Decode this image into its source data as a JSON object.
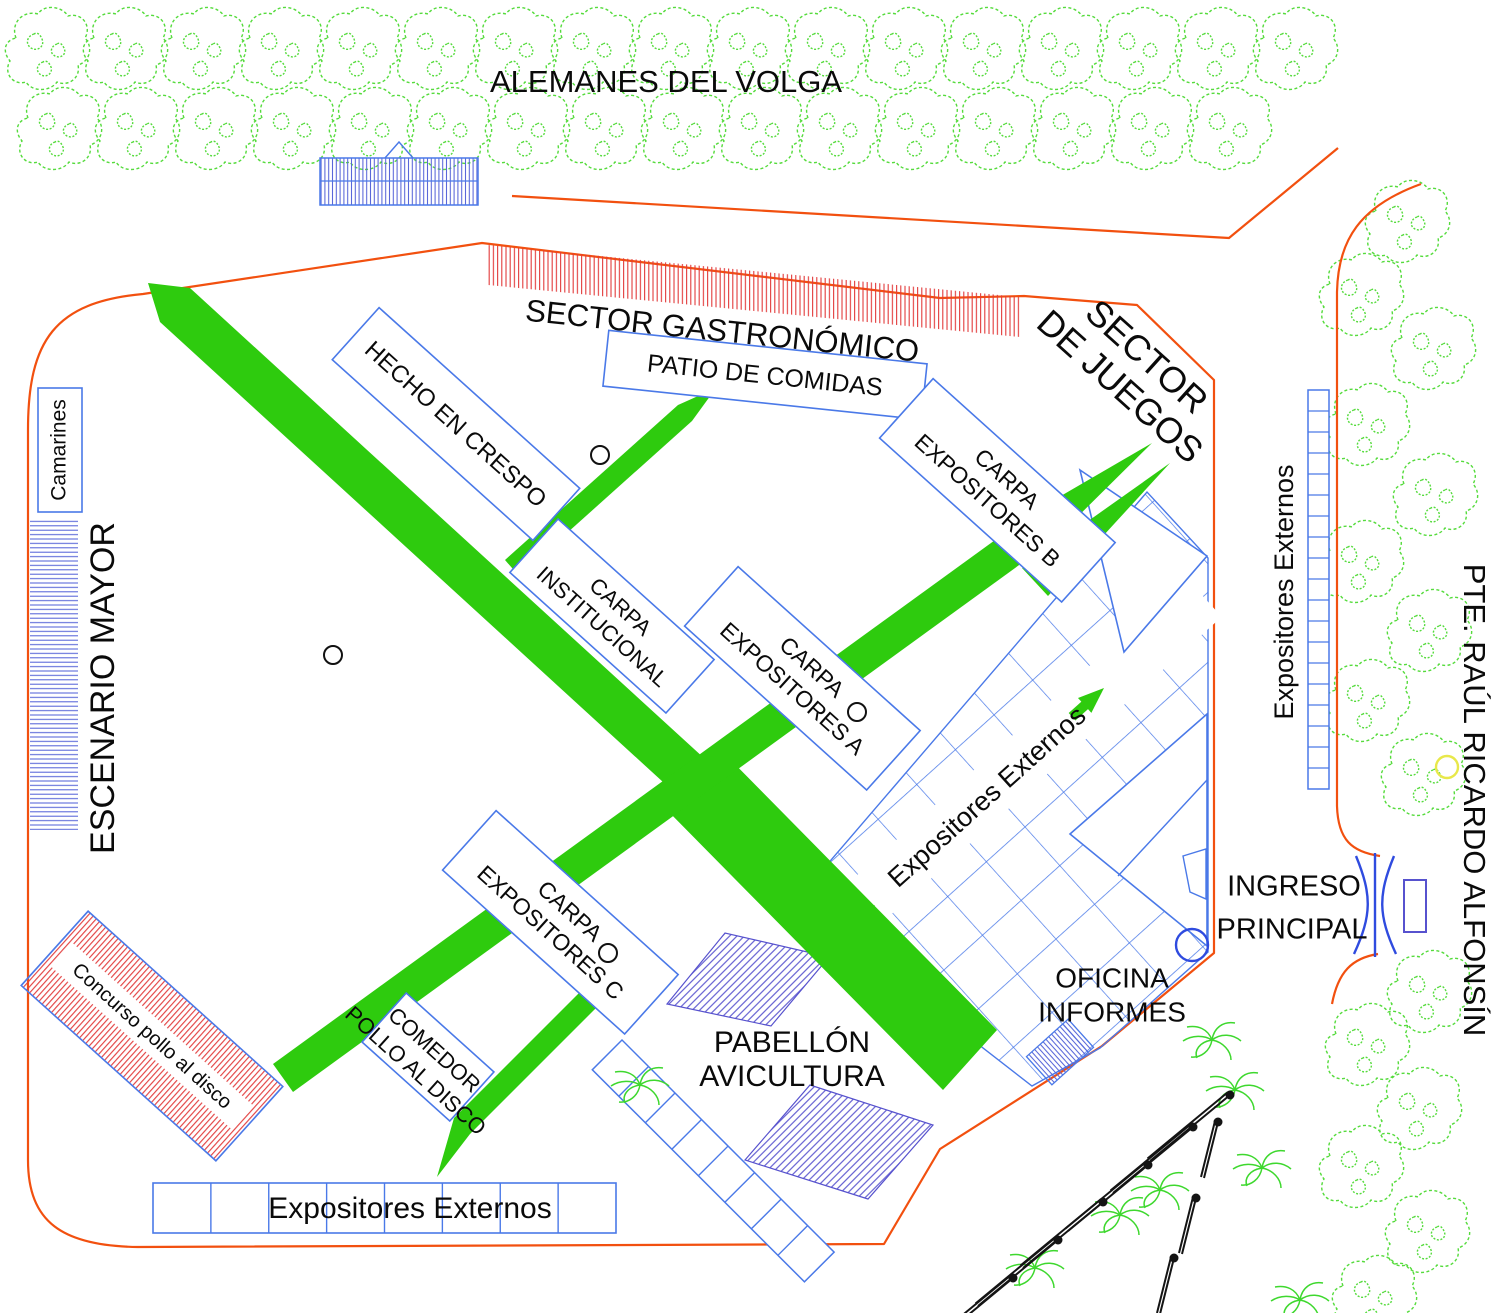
{
  "map": {
    "title": "Plano del predio ferial",
    "streets": {
      "top": "ALEMANES DEL VOLGA",
      "right": "PTE. RAÚL RICARDO ALFONSÍN"
    },
    "areas": {
      "sector_gastronomico": "SECTOR GASTRONÓMICO",
      "sector_juegos_l1": "SECTOR",
      "sector_juegos_l2": "DE JUEGOS",
      "patio_comidas": "PATIO DE COMIDAS",
      "hecho_en_crespo": "HECHO EN CRESPO",
      "camarines": "Camarines",
      "escenario_mayor": "ESCENARIO MAYOR",
      "carpa_institucional_l1": "CARPA",
      "carpa_institucional_l2": "INSTITUCIONAL",
      "carpa_a_l1": "CARPA",
      "carpa_a_l2": "EXPOSITORES A",
      "carpa_b_l1": "CARPA",
      "carpa_b_l2": "EXPOSITORES B",
      "carpa_c_l1": "CARPA",
      "carpa_c_l2": "EXPOSITORES C",
      "comedor_l1": "COMEDOR",
      "comedor_l2": "POLLO AL DISCO",
      "concurso_pollo": "Concurso pollo al disco",
      "pabellon_l1": "PABELLÓN",
      "pabellon_l2": "AVICULTURA",
      "oficina_l1": "OFICINA",
      "oficina_l2": "INFORMES",
      "ingreso_l1": "INGRESO",
      "ingreso_l2": "PRINCIPAL",
      "expositores_lane": "Expositores Externos",
      "expositores_bottom": "Expositores Externos",
      "expositores_right": "Expositores Externos"
    },
    "stalls": {
      "bottom_row_cells": 8,
      "right_column_cells": 19,
      "diagonal_ladder_cells": 8
    },
    "icons": [
      "tree-icon",
      "palm-icon",
      "light-pole-icon",
      "entrance-gate-icon",
      "stage-hatch",
      "food-sector-hatch"
    ],
    "colors": {
      "path_green": "#2ECB0E",
      "tree_green": "#55DB3C",
      "boundary_orange": "#F2500F",
      "hatch_red": "#E23A3A",
      "outline_blue": "#4A79E8",
      "hatch_blue": "#5663D8",
      "marker_blue": "#2F4BDF",
      "text_black": "#0A0A0A",
      "text_blue": "#2233CC",
      "yellow": "#E8E84A"
    }
  }
}
